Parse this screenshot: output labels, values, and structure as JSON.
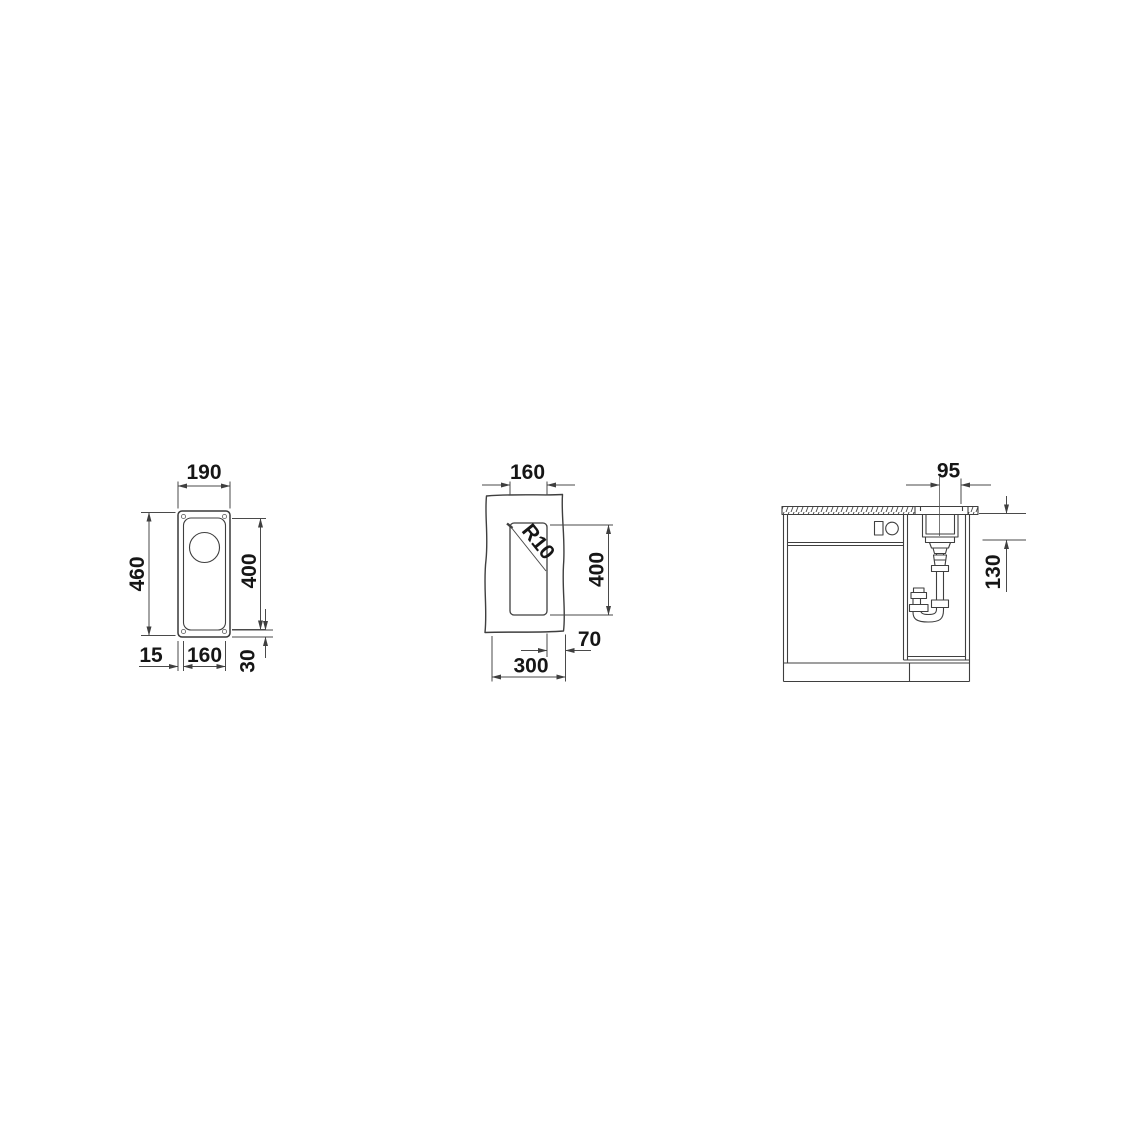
{
  "colors": {
    "background": "#ffffff",
    "object_line": "#383838",
    "dimension_line": "#4a4a4a",
    "label_text": "#161616"
  },
  "top_view": {
    "overall_width_mm": "190",
    "overall_depth_mm": "460",
    "bowl_depth_mm": "400",
    "rim_offset_left_mm": "15",
    "bowl_width_mm": "160",
    "rim_offset_bottom_mm": "30"
  },
  "cutout_view": {
    "cutout_width_mm": "160",
    "corner_radius_label": "R10",
    "cutout_length_mm": "400",
    "edge_distance_mm": "70",
    "cabinet_width_mm": "300"
  },
  "installation_view": {
    "drain_offset_mm": "95",
    "bowl_depth_below_worktop_mm": "130"
  }
}
